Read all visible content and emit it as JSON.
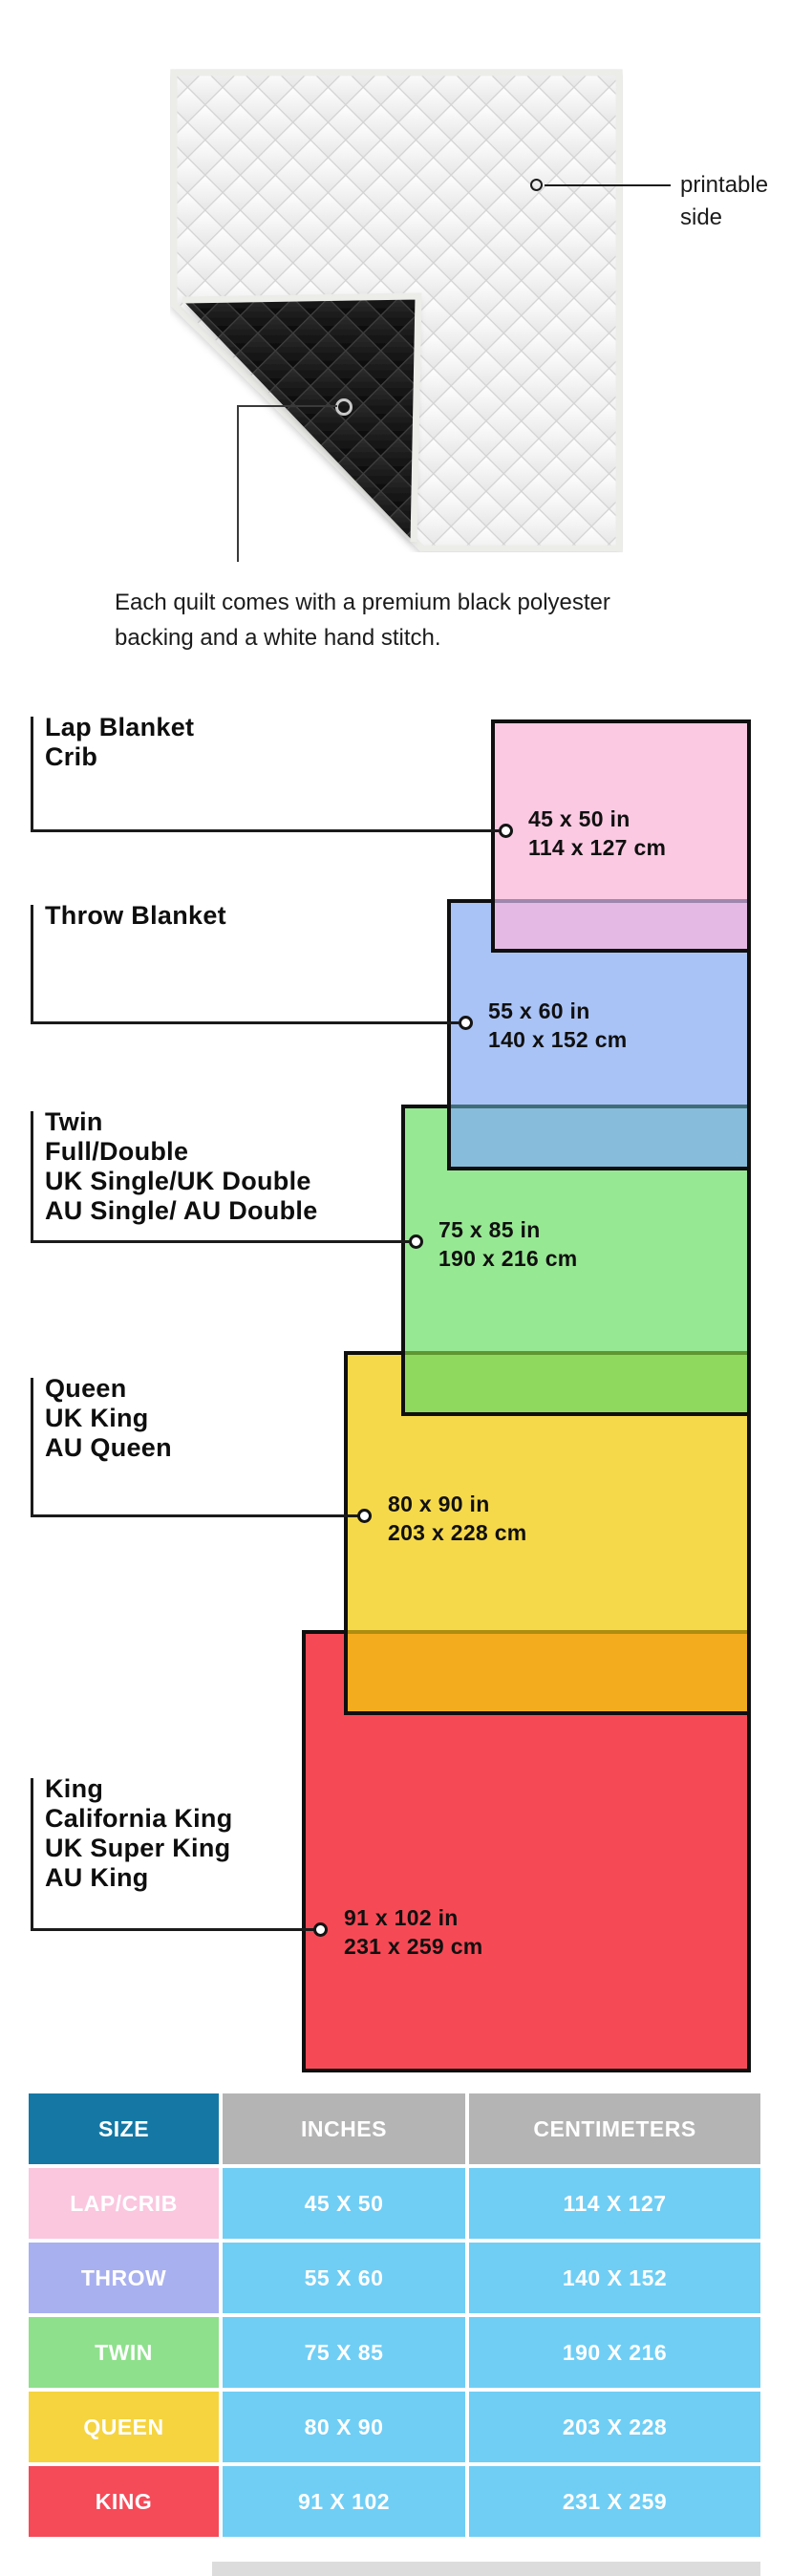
{
  "quilt": {
    "printable_label": {
      "line1": "printable",
      "line2": "side"
    },
    "caption": {
      "line1": "Each quilt comes with a premium black polyester",
      "line2": "backing and a white hand stitch."
    },
    "colors": {
      "binding": "#ecece9",
      "white_quilt_line": "#d2d2d2",
      "black_backing": "#161616",
      "black_quilt_line": "#3f3f3f",
      "marker_ring_dark": "#1b1b1b",
      "marker_ring_light": "#c9c9c9"
    }
  },
  "diagram": {
    "leader_line_color": "#1b1b1b",
    "groups": [
      {
        "id": "lap-crib",
        "heading_lines": [
          "Lap Blanket",
          "Crib"
        ],
        "size_in": "45 x 50 in",
        "size_cm": "114 x 127 cm",
        "fill": "#FBC9E2"
      },
      {
        "id": "throw",
        "heading_lines": [
          "Throw Blanket"
        ],
        "size_in": "55 x 60 in",
        "size_cm": "140 x 152 cm",
        "fill": "#A9C3F6"
      },
      {
        "id": "twin",
        "heading_lines": [
          "Twin",
          "Full/Double",
          "UK Single/UK Double",
          "AU Single/ AU Double"
        ],
        "size_in": "75 x 85 in",
        "size_cm": "190 x 216 cm",
        "fill": "#97E893"
      },
      {
        "id": "queen",
        "heading_lines": [
          "Queen",
          "UK King",
          "AU Queen"
        ],
        "size_in": "80 x 90 in",
        "size_cm": "203 x 228 cm",
        "fill": "#F5D94B"
      },
      {
        "id": "king",
        "heading_lines": [
          "King",
          "California King",
          "UK Super King",
          "AU King"
        ],
        "size_in": "91 x 102 in",
        "size_cm": "231 x 259 cm",
        "fill": "#F54A56"
      }
    ],
    "overlaps": [
      {
        "between": "lap-over-throw",
        "fill": "#E4BAE4",
        "edge": "#9F87AC"
      },
      {
        "between": "throw-over-twin",
        "fill": "#87BCDA",
        "edge": "#3F6E78"
      },
      {
        "between": "twin-over-queen",
        "fill": "#8FD95E",
        "edge": "#5E9732"
      },
      {
        "between": "queen-over-king",
        "fill": "#F4AC1F",
        "edge": "#AD8D10"
      }
    ],
    "border_color": "#0f0f0f"
  },
  "table": {
    "headers": {
      "size": "SIZE",
      "inches": "INCHES",
      "centimeters": "CENTIMETERS"
    },
    "header_colors": {
      "size_bg": "#1578A4",
      "metric_bg": "#B5B4B4"
    },
    "value_cell_bg": "#70CEF5",
    "text_color": "#FFFFFF",
    "rows": [
      {
        "label": "LAP/CRIB",
        "label_bg": "#FAC7DF",
        "inches": "45 X 50",
        "cm": "114 X 127"
      },
      {
        "label": "THROW",
        "label_bg": "#A9B0F0",
        "inches": "55 X 60",
        "cm": "140 X 152"
      },
      {
        "label": "TWIN",
        "label_bg": "#8EE08C",
        "inches": "75 X 85",
        "cm": "190 X 216"
      },
      {
        "label": "QUEEN",
        "label_bg": "#F5D440",
        "inches": "80 X 90",
        "cm": "203 X 228"
      },
      {
        "label": "KING",
        "label_bg": "#F54A58",
        "inches": "91 X 102",
        "cm": "231 X 259"
      }
    ]
  }
}
